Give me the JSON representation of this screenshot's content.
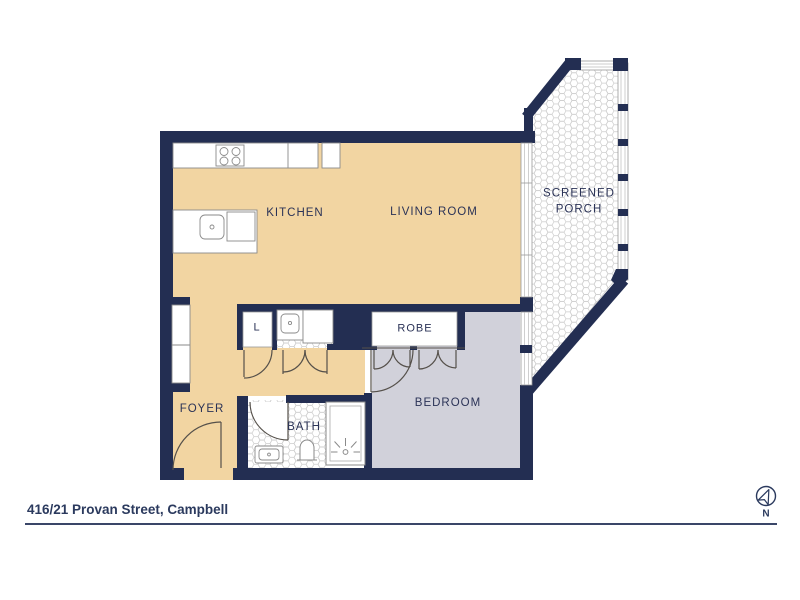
{
  "title_bar": {
    "address": "416/21 Provan Street, Campbell"
  },
  "compass": {
    "label": "N"
  },
  "rooms": {
    "kitchen": "KITCHEN",
    "living_room": "LIVING ROOM",
    "screened_porch_line1": "SCREENED",
    "screened_porch_line2": "PORCH",
    "robe": "ROBE",
    "bedroom": "BEDROOM",
    "foyer": "FOYER",
    "bath": "BATH",
    "linen_closet": "L"
  },
  "colors": {
    "wall_navy": "#232e52",
    "label_navy": "#2b3357",
    "floor_tan": "#f2d5a2",
    "floor_grey": "#d1d1da",
    "tile_outline": "#cccccc"
  }
}
